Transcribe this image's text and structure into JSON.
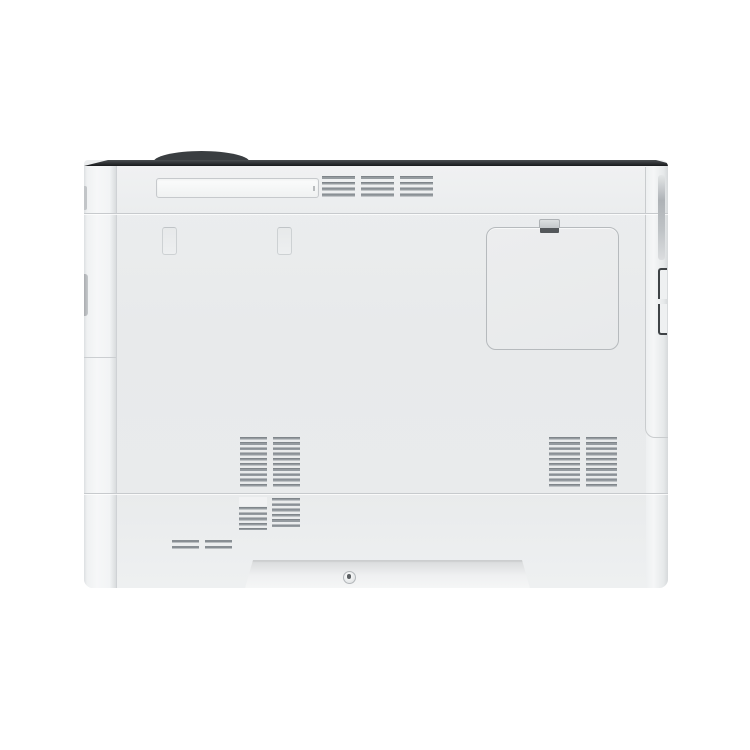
{
  "scene": {
    "type": "product-photo",
    "subject": "laser printer, side panel view on white background",
    "visible_text": ""
  },
  "colors": {
    "bg": "#ffffff",
    "body": "#e9ebec",
    "panel-top": "#edeff0",
    "seam": "#c7cacd",
    "edge-dark": "#181a1c",
    "edge-dark-top": "#4a4e51",
    "hump": "#3a3e41",
    "vent-slat": "#878d92",
    "door-border": "#b6babd",
    "latch-dark": "#54585b",
    "bracket": "#3f4346",
    "recess-top": "#d8dadb",
    "recess-bottom": "#f5f6f6",
    "screw-border": "#b3b7ba"
  },
  "components": {
    "top_edge": "dark chamfered top edge strip",
    "control_panel_hump": "dark curved top of control panel behind edge",
    "carry_handle": "recessed horizontal carrying-handle slot",
    "top_vent": {
      "columns": 3,
      "slats_per_column": 4
    },
    "mounting_slots": {
      "count": 2
    },
    "access_door": {
      "shape": "rounded square panel",
      "latch": "spring clip latch at top"
    },
    "side_vent_left": {
      "columns": 2,
      "slats_per_column": 10
    },
    "side_vent_right": {
      "columns": 2,
      "slats_per_column": 10
    },
    "lower_vent": {
      "columns": 2,
      "slats_per_column": 6
    },
    "small_vent": {
      "groups": 2,
      "slats_per_group": 2
    },
    "base_recess": "trapezoidal recessed base panel",
    "screw": "single screw centered in base recess",
    "grip_strip": "gray grip strip on right edge",
    "side_latch_bar": "dark recessed latch bracket on right edge"
  }
}
